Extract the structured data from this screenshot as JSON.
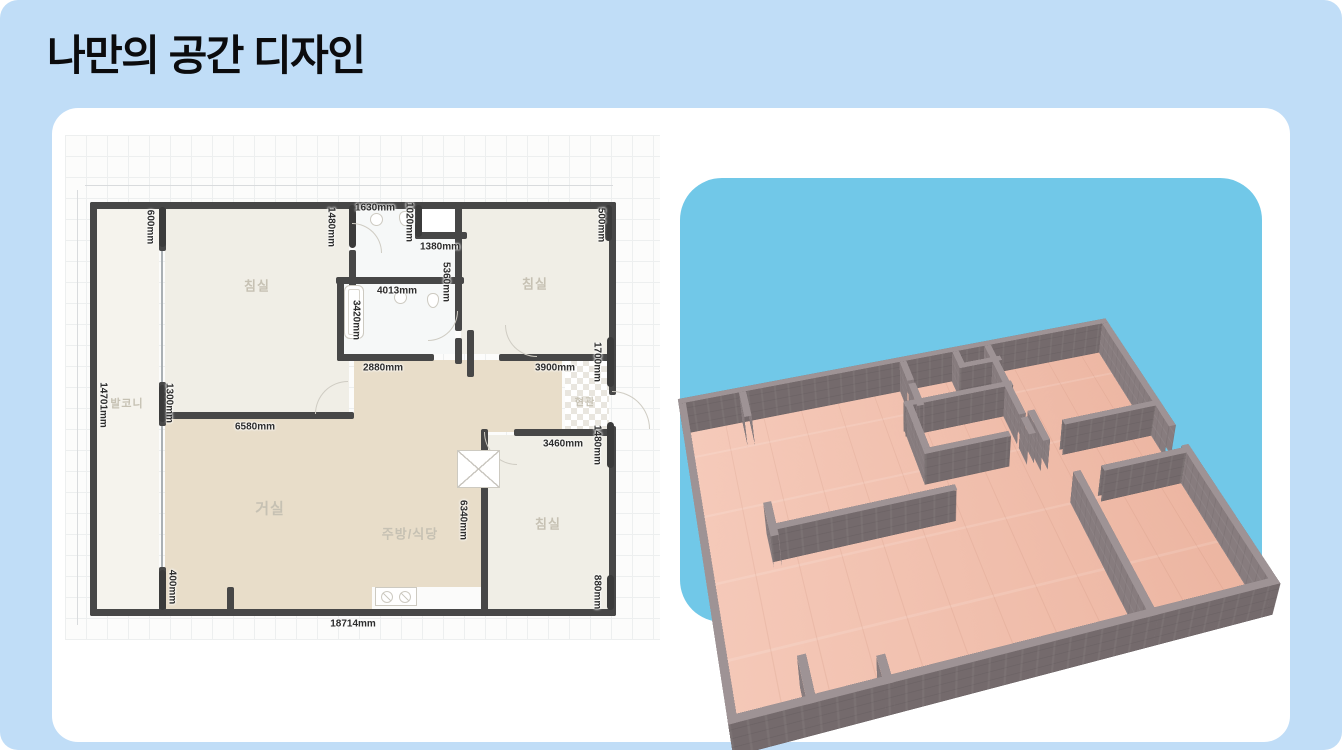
{
  "page": {
    "title": "나만의 공간 디자인",
    "bg": "#c0ddf7",
    "title_color": "#0b0b0d"
  },
  "card": {
    "bg": "#ffffff"
  },
  "floorplan": {
    "paper_bg": "#fcfcfb",
    "grid_color": "#edefef",
    "wall_color": "#474747",
    "wall_t": 7,
    "lines": [
      {
        "x": 20,
        "y": 50,
        "w": 528,
        "h": 1
      },
      {
        "x": 12,
        "y": 55,
        "w": 1,
        "h": 435
      }
    ],
    "rooms": [
      {
        "n": "balcony",
        "x": 31,
        "y": 73,
        "w": 63,
        "h": 401,
        "f": "#f5f3ed"
      },
      {
        "n": "bedroom-1",
        "x": 100,
        "y": 73,
        "w": 184,
        "h": 204,
        "f": "#f0eee6"
      },
      {
        "n": "bedroom-2",
        "x": 396,
        "y": 73,
        "w": 148,
        "h": 146,
        "f": "#f0eee6"
      },
      {
        "n": "bathroom-1",
        "x": 290,
        "y": 73,
        "w": 100,
        "h": 69,
        "f": "#f6f8f8"
      },
      {
        "n": "closet",
        "x": 356,
        "y": 73,
        "w": 40,
        "h": 24,
        "f": "#ffffff"
      },
      {
        "n": "bathroom-2",
        "x": 278,
        "y": 148,
        "w": 112,
        "h": 71,
        "f": "#f6f8f8"
      },
      {
        "n": "bedroom-3",
        "x": 422,
        "y": 300,
        "w": 122,
        "h": 174,
        "f": "#f0eee6"
      },
      {
        "n": "wood-upper",
        "x": 289,
        "y": 225,
        "w": 208,
        "h": 72,
        "f": "#e8ddc9"
      },
      {
        "n": "wood-living",
        "x": 100,
        "y": 283,
        "w": 319,
        "h": 191,
        "f": "#e8ddc9"
      },
      {
        "n": "kitchen-counter",
        "x": 307,
        "y": 452,
        "w": 112,
        "h": 22,
        "f": "#fbfbfa"
      },
      {
        "n": "entry",
        "x": 500,
        "y": 225,
        "w": 44,
        "h": 69,
        "f": "checker"
      }
    ],
    "windows": [
      [
        97,
        112,
        97,
        250
      ],
      [
        97,
        287,
        97,
        435
      ]
    ],
    "walls": [
      [
        28,
        70,
        547,
        70
      ],
      [
        28,
        70,
        28,
        477
      ],
      [
        28,
        477,
        547,
        477
      ],
      [
        547,
        70,
        547,
        256
      ],
      [
        547,
        294,
        547,
        477
      ],
      [
        97,
        70,
        97,
        112
      ],
      [
        97,
        250,
        97,
        287
      ],
      [
        97,
        435,
        97,
        477
      ],
      [
        97,
        280,
        285,
        280
      ],
      [
        275,
        222,
        365,
        222
      ],
      [
        437,
        222,
        547,
        222
      ],
      [
        287,
        70,
        287,
        104
      ],
      [
        287,
        118,
        287,
        148
      ],
      [
        353,
        70,
        353,
        100
      ],
      [
        353,
        100,
        398,
        100
      ],
      [
        393,
        70,
        393,
        192
      ],
      [
        393,
        206,
        393,
        225
      ],
      [
        274,
        145,
        395,
        145
      ],
      [
        275,
        145,
        275,
        222
      ],
      [
        405,
        198,
        405,
        238
      ],
      [
        452,
        297,
        547,
        297
      ],
      [
        419,
        297,
        419,
        477
      ],
      [
        165,
        455,
        165,
        477
      ]
    ],
    "bars": [
      [
        97,
        72,
        112
      ],
      [
        97,
        250,
        287
      ],
      [
        97,
        435,
        475
      ],
      [
        287,
        70,
        113
      ],
      [
        353,
        70,
        102
      ],
      [
        543,
        70,
        106
      ],
      [
        545,
        202,
        252
      ],
      [
        545,
        287,
        333
      ],
      [
        545,
        440,
        475
      ]
    ],
    "arcs": [
      {
        "x": 250,
        "y": 246,
        "r": 33,
        "c": "tl"
      },
      {
        "x": 287,
        "y": 88,
        "r": 30,
        "c": "tr"
      },
      {
        "x": 363,
        "y": 176,
        "r": 30,
        "c": "br"
      },
      {
        "x": 440,
        "y": 190,
        "r": 32,
        "c": "bl"
      },
      {
        "x": 547,
        "y": 256,
        "r": 38,
        "c": "tr"
      },
      {
        "x": 419,
        "y": 297,
        "r": 33,
        "c": "bl"
      }
    ],
    "fixtures": [
      {
        "t": "tub",
        "x": 279,
        "y": 150,
        "w": 20,
        "h": 54
      },
      {
        "t": "sink",
        "x": 305,
        "y": 78,
        "w": 13,
        "h": 13
      },
      {
        "t": "toilet",
        "x": 334,
        "y": 76,
        "w": 12,
        "h": 15
      },
      {
        "t": "sink",
        "x": 329,
        "y": 156,
        "w": 13,
        "h": 13
      },
      {
        "t": "toilet",
        "x": 362,
        "y": 158,
        "w": 12,
        "h": 15
      },
      {
        "t": "xbox",
        "x": 392,
        "y": 315,
        "w": 43,
        "h": 38
      },
      {
        "t": "stove",
        "x": 310,
        "y": 452,
        "w": 42,
        "h": 19
      }
    ],
    "dim_labels": [
      {
        "t": "1630mm",
        "x": 310,
        "y": 73
      },
      {
        "t": "1380mm",
        "x": 375,
        "y": 112
      },
      {
        "t": "4013mm",
        "x": 332,
        "y": 156
      },
      {
        "t": "2880mm",
        "x": 318,
        "y": 233
      },
      {
        "t": "3900mm",
        "x": 490,
        "y": 233
      },
      {
        "t": "6580mm",
        "x": 190,
        "y": 292
      },
      {
        "t": "3460mm",
        "x": 498,
        "y": 309
      },
      {
        "t": "18714mm",
        "x": 288,
        "y": 489
      },
      {
        "t": "600mm",
        "x": 85,
        "y": 92,
        "v": 1
      },
      {
        "t": "1480mm",
        "x": 266,
        "y": 92,
        "v": 1
      },
      {
        "t": "1020mm",
        "x": 344,
        "y": 87,
        "v": 1
      },
      {
        "t": "500mm",
        "x": 536,
        "y": 90,
        "v": 1
      },
      {
        "t": "5360mm",
        "x": 381,
        "y": 147,
        "v": 1
      },
      {
        "t": "3420mm",
        "x": 291,
        "y": 185,
        "v": 1
      },
      {
        "t": "1700mm",
        "x": 532,
        "y": 227,
        "v": 1
      },
      {
        "t": "14701mm",
        "x": 38,
        "y": 270,
        "v": 1
      },
      {
        "t": "1300mm",
        "x": 104,
        "y": 268,
        "v": 1
      },
      {
        "t": "1480mm",
        "x": 532,
        "y": 310,
        "v": 1
      },
      {
        "t": "6340mm",
        "x": 398,
        "y": 385,
        "v": 1
      },
      {
        "t": "400mm",
        "x": 107,
        "y": 452,
        "v": 1
      },
      {
        "t": "880mm",
        "x": 532,
        "y": 457,
        "v": 1
      }
    ],
    "room_labels": [
      {
        "t": "침실",
        "x": 192,
        "y": 150,
        "s": 13
      },
      {
        "t": "침실",
        "x": 470,
        "y": 148,
        "s": 13
      },
      {
        "t": "침실",
        "x": 483,
        "y": 388,
        "s": 13
      },
      {
        "t": "발코니",
        "x": 62,
        "y": 268,
        "s": 11
      },
      {
        "t": "거실",
        "x": 205,
        "y": 373,
        "s": 15
      },
      {
        "t": "주방/식당",
        "x": 345,
        "y": 398,
        "s": 13
      },
      {
        "t": "현관",
        "x": 520,
        "y": 266,
        "s": 10
      }
    ]
  },
  "view3d": {
    "panel_bg": "#71c8e8",
    "floor_color": "#f3bda9",
    "wall_front_color": "#746a6c",
    "wall_side_color": "#877c7e",
    "wall_top_color": "#9e9395",
    "wall_height": 44,
    "wall_thickness": 8,
    "plan_w": 519,
    "plan_h": 407,
    "render_w": 500,
    "render_h": 392,
    "plan_offset_x": 28,
    "plan_offset_y": 70
  }
}
